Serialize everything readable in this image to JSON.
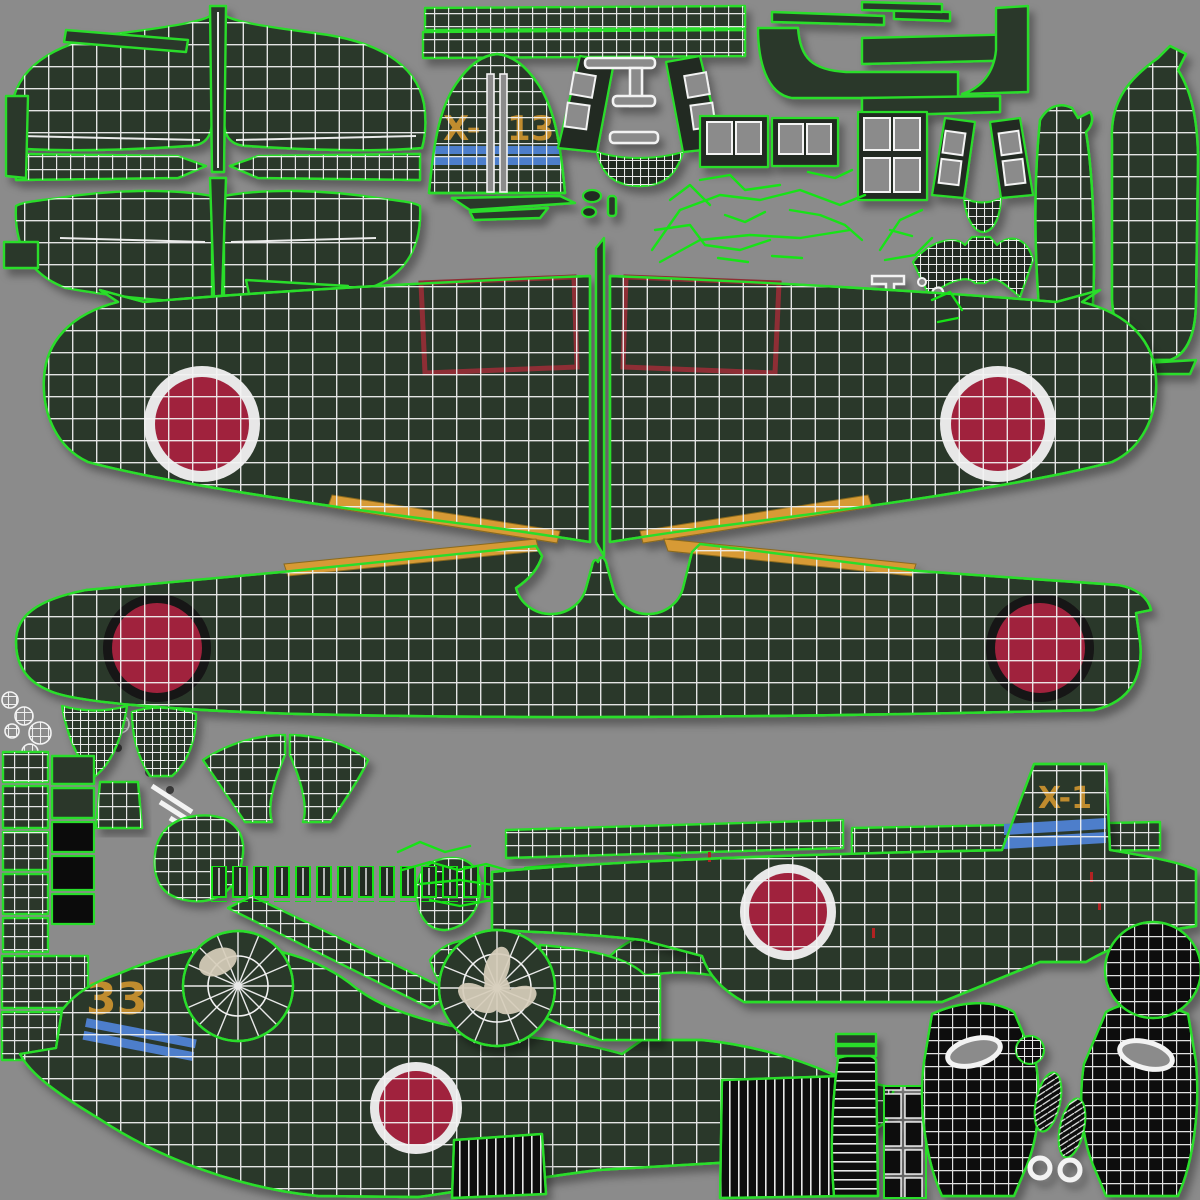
{
  "document": {
    "type": "uv-texture-atlas",
    "subject": "WWII Japanese fighter aircraft 3D-model texture with wireframe UV islands"
  },
  "markings": {
    "tail_code_prefix": "X-",
    "tail_code_suffix": "133",
    "fuselage_tail_code": "X-1",
    "rear_fuselage_code": "33"
  },
  "colors": {
    "island": "#2b372a",
    "islandDark": "#222b21",
    "wire": "#f3f3f3",
    "outline": "#29dd2b",
    "brightGreen": "#17e317",
    "red": "#a0233c",
    "ringWhite": "#e7e7e7",
    "ringBlack": "#131313",
    "orange": "#d79a36",
    "codeOrange": "#c08c2f",
    "blue": "#4d7ecb",
    "flapRed": "#8e2e36",
    "black": "#0b0b0b",
    "beige": "#d7cebb",
    "tickRed": "#b22222"
  },
  "islands": [
    "horizontal-stabilizer",
    "elevators",
    "vertical-tail-fin",
    "rudder-hinge-strips",
    "canopy-windshield-frames",
    "canopy-window-panels",
    "landing-gear-linkages",
    "wing-upper-left",
    "wing-upper-right",
    "wing-lower",
    "fuselage-spine-strips",
    "fuselage-right-side",
    "fuselage-left-side",
    "engine-cowling-front",
    "propeller-hub",
    "cowl-flaps",
    "wheel-covers",
    "tires",
    "engine-cylinder-row",
    "misc-small-parts"
  ]
}
